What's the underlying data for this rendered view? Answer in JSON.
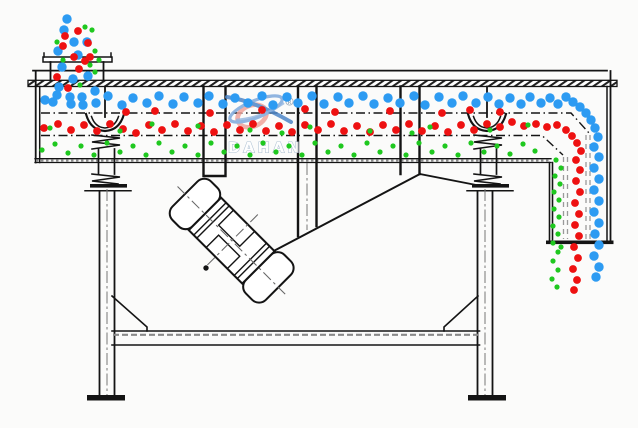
{
  "diagram": {
    "title": "linear-vibrating-screen-cross-section",
    "background": "#fbfbfa",
    "ink": "#141414",
    "gray": "#8a8a8a",
    "light_gray": "#9a9a9a"
  },
  "watermark": {
    "brand": "DAHAN",
    "registered": "®",
    "swoosh_pink": "#F0A49B",
    "swoosh_blue": "#7FA9DC",
    "swoosh_blue_dark": "#4E86C8",
    "text_fill": "#ffffff",
    "text_outline": "#9FB6CC"
  },
  "particles": {
    "coarse_blue": {
      "color": "#2D9BF2",
      "radius": 4.7,
      "points": [
        [
          64,
          30
        ],
        [
          74,
          42
        ],
        [
          58,
          51
        ],
        [
          87,
          42
        ],
        [
          78,
          55
        ],
        [
          62,
          67
        ],
        [
          73,
          79
        ],
        [
          88,
          76
        ],
        [
          59,
          87
        ],
        [
          70,
          97
        ],
        [
          53,
          102
        ],
        [
          83,
          105
        ],
        [
          95,
          91
        ],
        [
          67,
          19
        ],
        [
          45,
          100
        ],
        [
          57,
          95
        ],
        [
          71,
          104
        ],
        [
          82,
          97
        ],
        [
          96,
          103
        ],
        [
          108,
          96
        ],
        [
          122,
          105
        ],
        [
          133,
          98
        ],
        [
          147,
          103
        ],
        [
          159,
          96
        ],
        [
          173,
          104
        ],
        [
          184,
          97
        ],
        [
          198,
          103
        ],
        [
          209,
          96
        ],
        [
          223,
          104
        ],
        [
          235,
          98
        ],
        [
          248,
          103
        ],
        [
          262,
          96
        ],
        [
          273,
          105
        ],
        [
          287,
          97
        ],
        [
          298,
          103
        ],
        [
          312,
          96
        ],
        [
          324,
          104
        ],
        [
          338,
          97
        ],
        [
          349,
          103
        ],
        [
          363,
          96
        ],
        [
          374,
          104
        ],
        [
          388,
          98
        ],
        [
          400,
          103
        ],
        [
          414,
          96
        ],
        [
          425,
          105
        ],
        [
          439,
          97
        ],
        [
          452,
          103
        ],
        [
          463,
          96
        ],
        [
          476,
          103
        ],
        [
          488,
          97
        ],
        [
          499,
          104
        ],
        [
          510,
          98
        ],
        [
          521,
          104
        ],
        [
          530,
          97
        ],
        [
          541,
          103
        ],
        [
          550,
          98
        ],
        [
          558,
          104
        ],
        [
          566,
          97
        ],
        [
          573,
          102
        ],
        [
          580,
          107
        ],
        [
          586,
          113
        ],
        [
          591,
          120
        ],
        [
          595,
          128
        ],
        [
          598,
          137
        ],
        [
          594,
          147
        ],
        [
          599,
          157
        ],
        [
          594,
          168
        ],
        [
          599,
          179
        ],
        [
          594,
          190
        ],
        [
          599,
          201
        ],
        [
          594,
          212
        ],
        [
          599,
          223
        ],
        [
          595,
          234
        ],
        [
          599,
          245
        ],
        [
          594,
          256
        ],
        [
          599,
          267
        ],
        [
          596,
          277
        ]
      ]
    },
    "medium_red": {
      "color": "#EE1111",
      "radius": 3.9,
      "points": [
        [
          78,
          31
        ],
        [
          88,
          43
        ],
        [
          63,
          46
        ],
        [
          74,
          57
        ],
        [
          85,
          61
        ],
        [
          57,
          77
        ],
        [
          68,
          88
        ],
        [
          79,
          69
        ],
        [
          90,
          57
        ],
        [
          65,
          36
        ],
        [
          126,
          112
        ],
        [
          155,
          111
        ],
        [
          210,
          113
        ],
        [
          262,
          110
        ],
        [
          335,
          112
        ],
        [
          390,
          111
        ],
        [
          442,
          113
        ],
        [
          470,
          110
        ],
        [
          500,
          112
        ],
        [
          305,
          109
        ],
        [
          44,
          128
        ],
        [
          58,
          124
        ],
        [
          71,
          130
        ],
        [
          84,
          125
        ],
        [
          97,
          131
        ],
        [
          110,
          124
        ],
        [
          123,
          129
        ],
        [
          136,
          133
        ],
        [
          149,
          125
        ],
        [
          162,
          130
        ],
        [
          175,
          124
        ],
        [
          188,
          131
        ],
        [
          201,
          126
        ],
        [
          214,
          132
        ],
        [
          227,
          125
        ],
        [
          240,
          130
        ],
        [
          253,
          124
        ],
        [
          266,
          131
        ],
        [
          279,
          126
        ],
        [
          292,
          132
        ],
        [
          305,
          125
        ],
        [
          318,
          130
        ],
        [
          331,
          124
        ],
        [
          344,
          131
        ],
        [
          357,
          126
        ],
        [
          370,
          132
        ],
        [
          383,
          125
        ],
        [
          396,
          130
        ],
        [
          409,
          124
        ],
        [
          422,
          131
        ],
        [
          435,
          126
        ],
        [
          448,
          132
        ],
        [
          461,
          125
        ],
        [
          474,
          130
        ],
        [
          487,
          124
        ],
        [
          500,
          127
        ],
        [
          512,
          122
        ],
        [
          524,
          126
        ],
        [
          536,
          124
        ],
        [
          547,
          127
        ],
        [
          557,
          125
        ],
        [
          566,
          130
        ],
        [
          572,
          136
        ],
        [
          577,
          143
        ],
        [
          581,
          151
        ],
        [
          576,
          160
        ],
        [
          580,
          170
        ],
        [
          576,
          181
        ],
        [
          580,
          192
        ],
        [
          575,
          203
        ],
        [
          579,
          214
        ],
        [
          575,
          225
        ],
        [
          579,
          236
        ],
        [
          574,
          247
        ],
        [
          578,
          258
        ],
        [
          573,
          269
        ],
        [
          577,
          280
        ],
        [
          574,
          290
        ]
      ]
    },
    "fine_green": {
      "color": "#1FC81F",
      "radius": 2.6,
      "points": [
        [
          92,
          30
        ],
        [
          95,
          51
        ],
        [
          63,
          60
        ],
        [
          90,
          65
        ],
        [
          80,
          85
        ],
        [
          95,
          72
        ],
        [
          57,
          42
        ],
        [
          85,
          27
        ],
        [
          99,
          60
        ],
        [
          50,
          128
        ],
        [
          120,
          131
        ],
        [
          198,
          126
        ],
        [
          250,
          130
        ],
        [
          310,
          127
        ],
        [
          370,
          131
        ],
        [
          430,
          127
        ],
        [
          490,
          130
        ],
        [
          528,
          125
        ],
        [
          152,
          124
        ],
        [
          282,
          133
        ],
        [
          412,
          133
        ],
        [
          42,
          150
        ],
        [
          55,
          144
        ],
        [
          68,
          153
        ],
        [
          81,
          146
        ],
        [
          94,
          155
        ],
        [
          107,
          143
        ],
        [
          120,
          152
        ],
        [
          133,
          146
        ],
        [
          146,
          155
        ],
        [
          159,
          143
        ],
        [
          172,
          152
        ],
        [
          185,
          146
        ],
        [
          198,
          155
        ],
        [
          211,
          143
        ],
        [
          224,
          152
        ],
        [
          237,
          146
        ],
        [
          250,
          155
        ],
        [
          263,
          143
        ],
        [
          276,
          152
        ],
        [
          289,
          146
        ],
        [
          302,
          155
        ],
        [
          315,
          143
        ],
        [
          328,
          152
        ],
        [
          341,
          146
        ],
        [
          354,
          155
        ],
        [
          367,
          143
        ],
        [
          380,
          152
        ],
        [
          393,
          146
        ],
        [
          406,
          155
        ],
        [
          419,
          143
        ],
        [
          432,
          152
        ],
        [
          445,
          146
        ],
        [
          458,
          155
        ],
        [
          471,
          143
        ],
        [
          484,
          152
        ],
        [
          497,
          146
        ],
        [
          510,
          154
        ],
        [
          523,
          144
        ],
        [
          535,
          151
        ],
        [
          556,
          160
        ],
        [
          561,
          168
        ],
        [
          555,
          176
        ],
        [
          560,
          184
        ],
        [
          554,
          192
        ],
        [
          559,
          200
        ],
        [
          554,
          209
        ],
        [
          559,
          217
        ],
        [
          553,
          226
        ],
        [
          558,
          234
        ],
        [
          553,
          243
        ],
        [
          558,
          252
        ],
        [
          553,
          261
        ],
        [
          558,
          270
        ],
        [
          552,
          279
        ],
        [
          557,
          287
        ],
        [
          561,
          247
        ]
      ]
    }
  }
}
